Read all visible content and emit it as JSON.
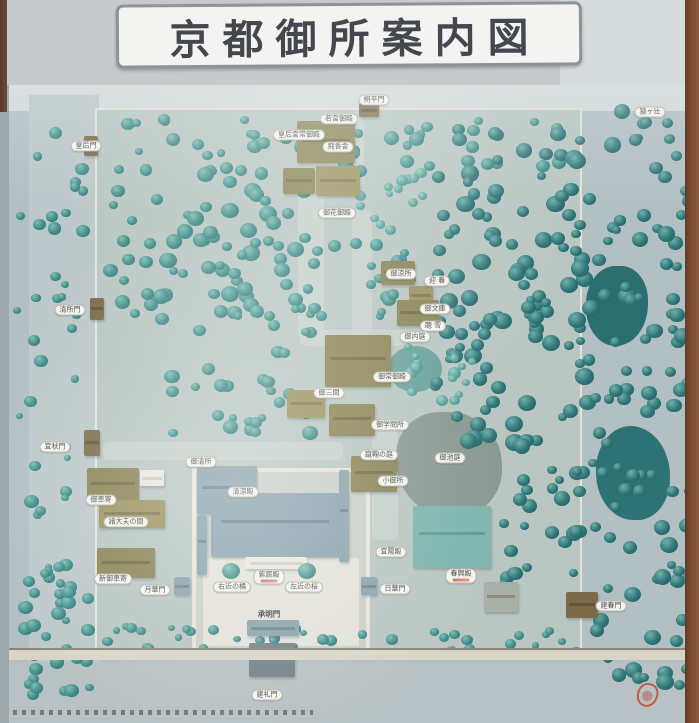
{
  "sign": {
    "title": "京都御所案内図"
  },
  "map": {
    "labels": [
      {
        "text": "朔平門",
        "x": 367,
        "y": 15,
        "style": "pill"
      },
      {
        "text": "猿ヶ辻",
        "x": 643,
        "y": 27,
        "style": "pill"
      },
      {
        "text": "皇后門",
        "x": 79,
        "y": 61,
        "style": "pill"
      },
      {
        "text": "若宮御殿",
        "x": 332,
        "y": 34,
        "style": "pill"
      },
      {
        "text": "皇后宮常御殿",
        "x": 292,
        "y": 50,
        "style": "pill"
      },
      {
        "text": "飛香舎",
        "x": 331,
        "y": 62,
        "style": "pill"
      },
      {
        "text": "御花御殿",
        "x": 330,
        "y": 128,
        "style": "pill"
      },
      {
        "text": "清所門",
        "x": 63,
        "y": 225,
        "style": "pill"
      },
      {
        "text": "御涼所",
        "x": 394,
        "y": 189,
        "style": "pill"
      },
      {
        "text": "迎 春",
        "x": 430,
        "y": 196,
        "style": "pill"
      },
      {
        "text": "御文庫",
        "x": 428,
        "y": 224,
        "style": "pill"
      },
      {
        "text": "聴 雪",
        "x": 426,
        "y": 241,
        "style": "pill"
      },
      {
        "text": "御内庭",
        "x": 408,
        "y": 252,
        "style": "pill"
      },
      {
        "text": "御常御殿",
        "x": 385,
        "y": 292,
        "style": "pill"
      },
      {
        "text": "御三間",
        "x": 322,
        "y": 308,
        "style": "pill"
      },
      {
        "text": "御学問所",
        "x": 383,
        "y": 340,
        "style": "pill"
      },
      {
        "text": "蹴鞠の庭",
        "x": 372,
        "y": 370,
        "style": "pill"
      },
      {
        "text": "御池庭",
        "x": 443,
        "y": 373,
        "style": "pill"
      },
      {
        "text": "小御所",
        "x": 386,
        "y": 396,
        "style": "pill"
      },
      {
        "text": "御清所",
        "x": 194,
        "y": 377,
        "style": "pill"
      },
      {
        "text": "宜秋門",
        "x": 48,
        "y": 362,
        "style": "pill"
      },
      {
        "text": "御車寄",
        "x": 94,
        "y": 415,
        "style": "pill"
      },
      {
        "text": "諸大夫の間",
        "x": 119,
        "y": 437,
        "style": "pill"
      },
      {
        "text": "新御車寄",
        "x": 106,
        "y": 494,
        "style": "pill"
      },
      {
        "text": "月華門",
        "x": 148,
        "y": 505,
        "style": "pill"
      },
      {
        "text": "清涼殿",
        "x": 236,
        "y": 407,
        "style": "pill"
      },
      {
        "text": "紫宸殿",
        "x": 262,
        "y": 492,
        "style": "pill",
        "sub": true
      },
      {
        "text": "右近の橘",
        "x": 225,
        "y": 502,
        "style": "pill"
      },
      {
        "text": "左近の桜",
        "x": 297,
        "y": 502,
        "style": "pill"
      },
      {
        "text": "宜陽殿",
        "x": 384,
        "y": 467,
        "style": "pill"
      },
      {
        "text": "日華門",
        "x": 388,
        "y": 504,
        "style": "pill"
      },
      {
        "text": "春興殿",
        "x": 454,
        "y": 491,
        "style": "pill",
        "sub": true
      },
      {
        "text": "承明門",
        "x": 262,
        "y": 529,
        "style": "plain"
      },
      {
        "text": "建春門",
        "x": 604,
        "y": 521,
        "style": "pill"
      },
      {
        "text": "建礼門",
        "x": 260,
        "y": 610,
        "style": "pill"
      }
    ]
  },
  "colors": {
    "tree_teal": "#3f8c88",
    "forest_dark": "#2f7476",
    "roof_olive": "#8a8455",
    "roof_blue": "#8ba2ac",
    "roof_teal": "#7eb5ad",
    "label_bg": "#f4f4ee",
    "frame_brown": "#7c4c33",
    "stamp_red": "#c23a2d"
  }
}
